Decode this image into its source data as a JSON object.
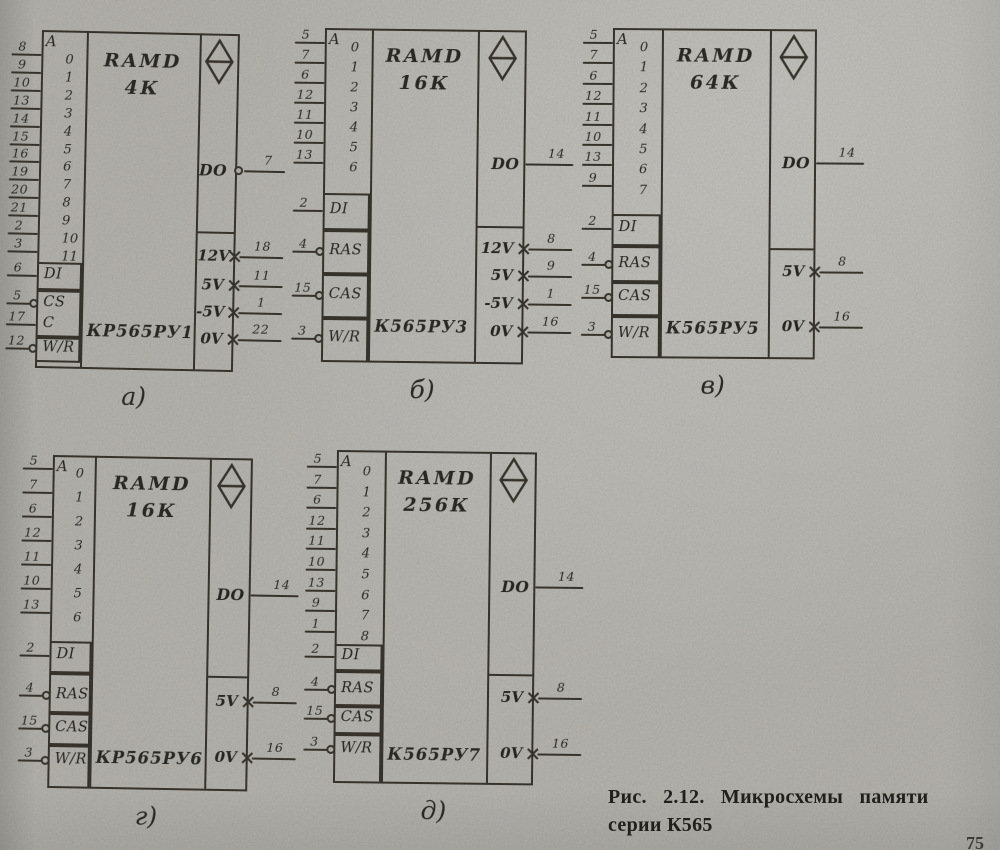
{
  "caption": {
    "line1": "Рис. 2.12. Микросхемы памяти",
    "line2": "серии К565",
    "page_number": "75"
  },
  "chips": [
    {
      "letter": "а)",
      "title": "RAMD",
      "capacity": "4К",
      "part_number": "КР565РУ1",
      "address_label": "A",
      "address_pins": [
        {
          "bit": "0",
          "pin": "8"
        },
        {
          "bit": "1",
          "pin": "9"
        },
        {
          "bit": "2",
          "pin": "10"
        },
        {
          "bit": "3",
          "pin": "13"
        },
        {
          "bit": "4",
          "pin": "14"
        },
        {
          "bit": "5",
          "pin": "15"
        },
        {
          "bit": "6",
          "pin": "16"
        },
        {
          "bit": "7",
          "pin": "19"
        },
        {
          "bit": "8",
          "pin": "20"
        },
        {
          "bit": "9",
          "pin": "21"
        },
        {
          "bit": "10",
          "pin": "2"
        },
        {
          "bit": "11",
          "pin": "3"
        }
      ],
      "control_boxes": [
        {
          "rows": [
            {
              "label": "DI",
              "pin": "6",
              "bubble": false
            }
          ]
        },
        {
          "rows": [
            {
              "label": "CS",
              "pin": "5",
              "bubble": true
            },
            {
              "label": "C",
              "pin": "17",
              "bubble": false
            }
          ]
        },
        {
          "rows": [
            {
              "label": "W/R",
              "pin": "12",
              "bubble": true
            }
          ]
        }
      ],
      "output": {
        "label": "DO",
        "pin": "7",
        "bubble": true
      },
      "power_pins": [
        {
          "label": "12V",
          "pin": "18"
        },
        {
          "label": "5V",
          "pin": "11"
        },
        {
          "label": "-5V",
          "pin": "1"
        },
        {
          "label": "0V",
          "pin": "22"
        }
      ]
    },
    {
      "letter": "б)",
      "title": "RAMD",
      "capacity": "16К",
      "part_number": "К565РУ3",
      "address_label": "A",
      "address_pins": [
        {
          "bit": "0",
          "pin": "5"
        },
        {
          "bit": "1",
          "pin": "7"
        },
        {
          "bit": "2",
          "pin": "6"
        },
        {
          "bit": "3",
          "pin": "12"
        },
        {
          "bit": "4",
          "pin": "11"
        },
        {
          "bit": "5",
          "pin": "10"
        },
        {
          "bit": "6",
          "pin": "13"
        }
      ],
      "control_boxes": [
        {
          "rows": [
            {
              "label": "DI",
              "pin": "2",
              "bubble": false
            }
          ]
        },
        {
          "rows": [
            {
              "label": "RAS",
              "pin": "4",
              "bubble": true
            }
          ]
        },
        {
          "rows": [
            {
              "label": "CAS",
              "pin": "15",
              "bubble": true
            }
          ]
        },
        {
          "rows": [
            {
              "label": "W/R",
              "pin": "3",
              "bubble": true
            }
          ]
        }
      ],
      "output": {
        "label": "DO",
        "pin": "14",
        "bubble": false
      },
      "power_pins": [
        {
          "label": "12V",
          "pin": "8"
        },
        {
          "label": "5V",
          "pin": "9"
        },
        {
          "label": "-5V",
          "pin": "1"
        },
        {
          "label": "0V",
          "pin": "16"
        }
      ]
    },
    {
      "letter": "в)",
      "title": "RAMD",
      "capacity": "64К",
      "part_number": "К565РУ5",
      "address_label": "A",
      "address_pins": [
        {
          "bit": "0",
          "pin": "5"
        },
        {
          "bit": "1",
          "pin": "7"
        },
        {
          "bit": "2",
          "pin": "6"
        },
        {
          "bit": "3",
          "pin": "12"
        },
        {
          "bit": "4",
          "pin": "11"
        },
        {
          "bit": "5",
          "pin": "10"
        },
        {
          "bit": "6",
          "pin": "13"
        },
        {
          "bit": "7",
          "pin": "9"
        }
      ],
      "control_boxes": [
        {
          "rows": [
            {
              "label": "DI",
              "pin": "2",
              "bubble": false
            }
          ]
        },
        {
          "rows": [
            {
              "label": "RAS",
              "pin": "4",
              "bubble": true
            }
          ]
        },
        {
          "rows": [
            {
              "label": "CAS",
              "pin": "15",
              "bubble": true
            }
          ]
        },
        {
          "rows": [
            {
              "label": "W/R",
              "pin": "3",
              "bubble": true
            }
          ]
        }
      ],
      "output": {
        "label": "DO",
        "pin": "14",
        "bubble": false
      },
      "power_pins": [
        {
          "label": "5V",
          "pin": "8"
        },
        {
          "label": "0V",
          "pin": "16"
        }
      ]
    },
    {
      "letter": "г)",
      "title": "RAMD",
      "capacity": "16К",
      "part_number": "КР565РУ6",
      "address_label": "A",
      "address_pins": [
        {
          "bit": "0",
          "pin": "5"
        },
        {
          "bit": "1",
          "pin": "7"
        },
        {
          "bit": "2",
          "pin": "6"
        },
        {
          "bit": "3",
          "pin": "12"
        },
        {
          "bit": "4",
          "pin": "11"
        },
        {
          "bit": "5",
          "pin": "10"
        },
        {
          "bit": "6",
          "pin": "13"
        }
      ],
      "control_boxes": [
        {
          "rows": [
            {
              "label": "DI",
              "pin": "2",
              "bubble": false
            }
          ]
        },
        {
          "rows": [
            {
              "label": "RAS",
              "pin": "4",
              "bubble": true
            }
          ]
        },
        {
          "rows": [
            {
              "label": "CAS",
              "pin": "15",
              "bubble": true
            }
          ]
        },
        {
          "rows": [
            {
              "label": "W/R",
              "pin": "3",
              "bubble": true
            }
          ]
        }
      ],
      "output": {
        "label": "DO",
        "pin": "14",
        "bubble": false
      },
      "power_pins": [
        {
          "label": "5V",
          "pin": "8"
        },
        {
          "label": "0V",
          "pin": "16"
        }
      ]
    },
    {
      "letter": "д)",
      "title": "RAMD",
      "capacity": "256К",
      "part_number": "К565РУ7",
      "address_label": "A",
      "address_pins": [
        {
          "bit": "0",
          "pin": "5"
        },
        {
          "bit": "1",
          "pin": "7"
        },
        {
          "bit": "2",
          "pin": "6"
        },
        {
          "bit": "3",
          "pin": "12"
        },
        {
          "bit": "4",
          "pin": "11"
        },
        {
          "bit": "5",
          "pin": "10"
        },
        {
          "bit": "6",
          "pin": "13"
        },
        {
          "bit": "7",
          "pin": "9"
        },
        {
          "bit": "8",
          "pin": "1"
        }
      ],
      "control_boxes": [
        {
          "rows": [
            {
              "label": "DI",
              "pin": "2",
              "bubble": false
            }
          ]
        },
        {
          "rows": [
            {
              "label": "RAS",
              "pin": "4",
              "bubble": true
            }
          ]
        },
        {
          "rows": [
            {
              "label": "CAS",
              "pin": "15",
              "bubble": true
            }
          ]
        },
        {
          "rows": [
            {
              "label": "W/R",
              "pin": "3",
              "bubble": true
            }
          ]
        }
      ],
      "output": {
        "label": "DO",
        "pin": "14",
        "bubble": false
      },
      "power_pins": [
        {
          "label": "5V",
          "pin": "8"
        },
        {
          "label": "0V",
          "pin": "16"
        }
      ]
    }
  ]
}
